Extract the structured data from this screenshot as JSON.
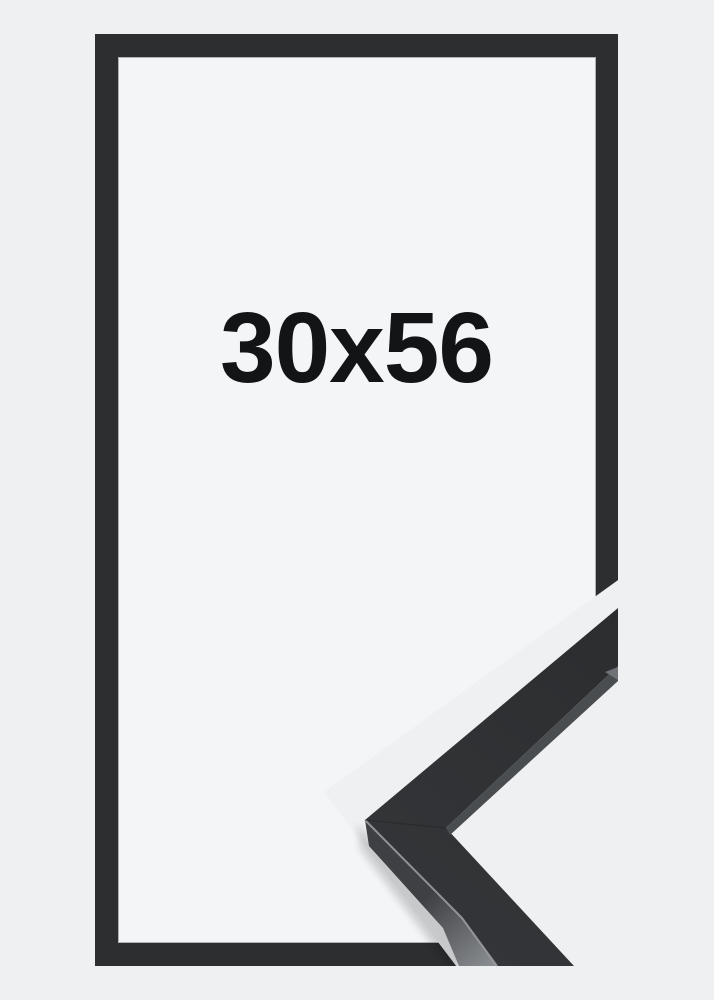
{
  "image": {
    "size_label": "30x56"
  },
  "colors": {
    "background": "#eff0f2",
    "frame_interior": "#f4f5f6",
    "frame": "#2c2e30",
    "frame_lip": "#797c7f",
    "moulding_front_tip": "#2b2d2f",
    "moulding_front_corner": "#333538",
    "moulding_side_dark": "#3e4043",
    "moulding_side_light": "#898c90",
    "moulding_inner_edge": "#4a4d50",
    "moulding_tip_facet": "#6f7276",
    "edge_highlight": "#9da0a3",
    "miter_seam": "#1f2123",
    "text": "#131416"
  }
}
